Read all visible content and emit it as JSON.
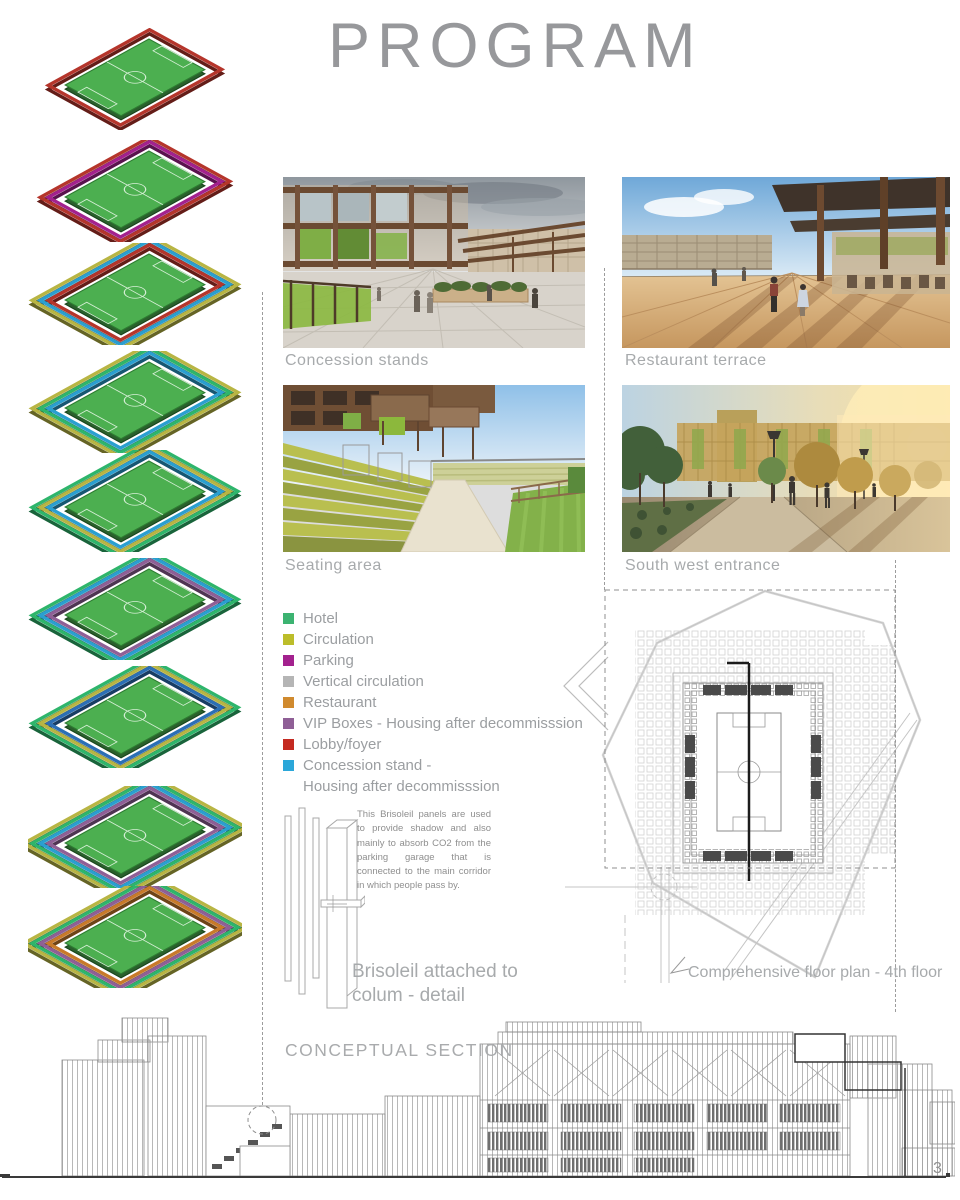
{
  "page": {
    "title": "PROGRAM",
    "page_number": "3"
  },
  "renders": {
    "concession": {
      "caption": "Concession stands"
    },
    "terrace": {
      "caption": "Restaurant terrace"
    },
    "seating": {
      "caption": "Seating area"
    },
    "entrance": {
      "caption": "South west entrance"
    }
  },
  "legend": {
    "items": [
      {
        "label": "Hotel",
        "color": "#3cb371"
      },
      {
        "label": "Circulation",
        "color": "#bcbd2a"
      },
      {
        "label": "Parking",
        "color": "#a3218e"
      },
      {
        "label": "Vertical circulation",
        "color": "#b5b5b5"
      },
      {
        "label": "Restaurant",
        "color": "#d08a2e"
      },
      {
        "label": "VIP Boxes - Housing after decommisssion",
        "color": "#8f5f96"
      },
      {
        "label": "Lobby/foyer",
        "color": "#c42a21"
      },
      {
        "label": "Concession stand -",
        "label2": "Housing after decommisssion",
        "color": "#2ba7d9"
      }
    ]
  },
  "brisoleil": {
    "text": "This Brisoleil panels are used to provide shadow and also mainly to absorb CO2 from the parking garage that is connected to the main corridor in which people pass by.",
    "caption": "Brisoleil attached to colum - detail"
  },
  "floor_plan": {
    "caption": "Comprehensive floor plan - 4th floor"
  },
  "section": {
    "label": "CONCEPTUAL SECTION"
  },
  "axons": {
    "field_color": "#4caf50",
    "levels": [
      {
        "name": "level-1",
        "stripes": [
          "#b5352b"
        ]
      },
      {
        "name": "level-2",
        "stripes": [
          "#b5352b",
          "#a3218e"
        ]
      },
      {
        "name": "level-3",
        "stripes": [
          "#b8b543",
          "#2a9fd0",
          "#b5352b"
        ]
      },
      {
        "name": "level-4",
        "stripes": [
          "#b8b543",
          "#2eb56b",
          "#2a9fd0"
        ]
      },
      {
        "name": "level-5",
        "stripes": [
          "#2eb56b",
          "#b8b543",
          "#2a9fd0"
        ]
      },
      {
        "name": "level-6",
        "stripes": [
          "#2eb56b",
          "#2a9fd0",
          "#8f5f96"
        ]
      },
      {
        "name": "level-7",
        "stripes": [
          "#2eb56b",
          "#b8b543",
          "#2b6fb5"
        ]
      },
      {
        "name": "level-8",
        "stripes": [
          "#b8b543",
          "#2eb56b",
          "#2a9fd0",
          "#8f5f96"
        ]
      },
      {
        "name": "level-9",
        "stripes": [
          "#b8b543",
          "#2eb56b",
          "#8f5f96",
          "#c87a2a"
        ]
      }
    ]
  }
}
